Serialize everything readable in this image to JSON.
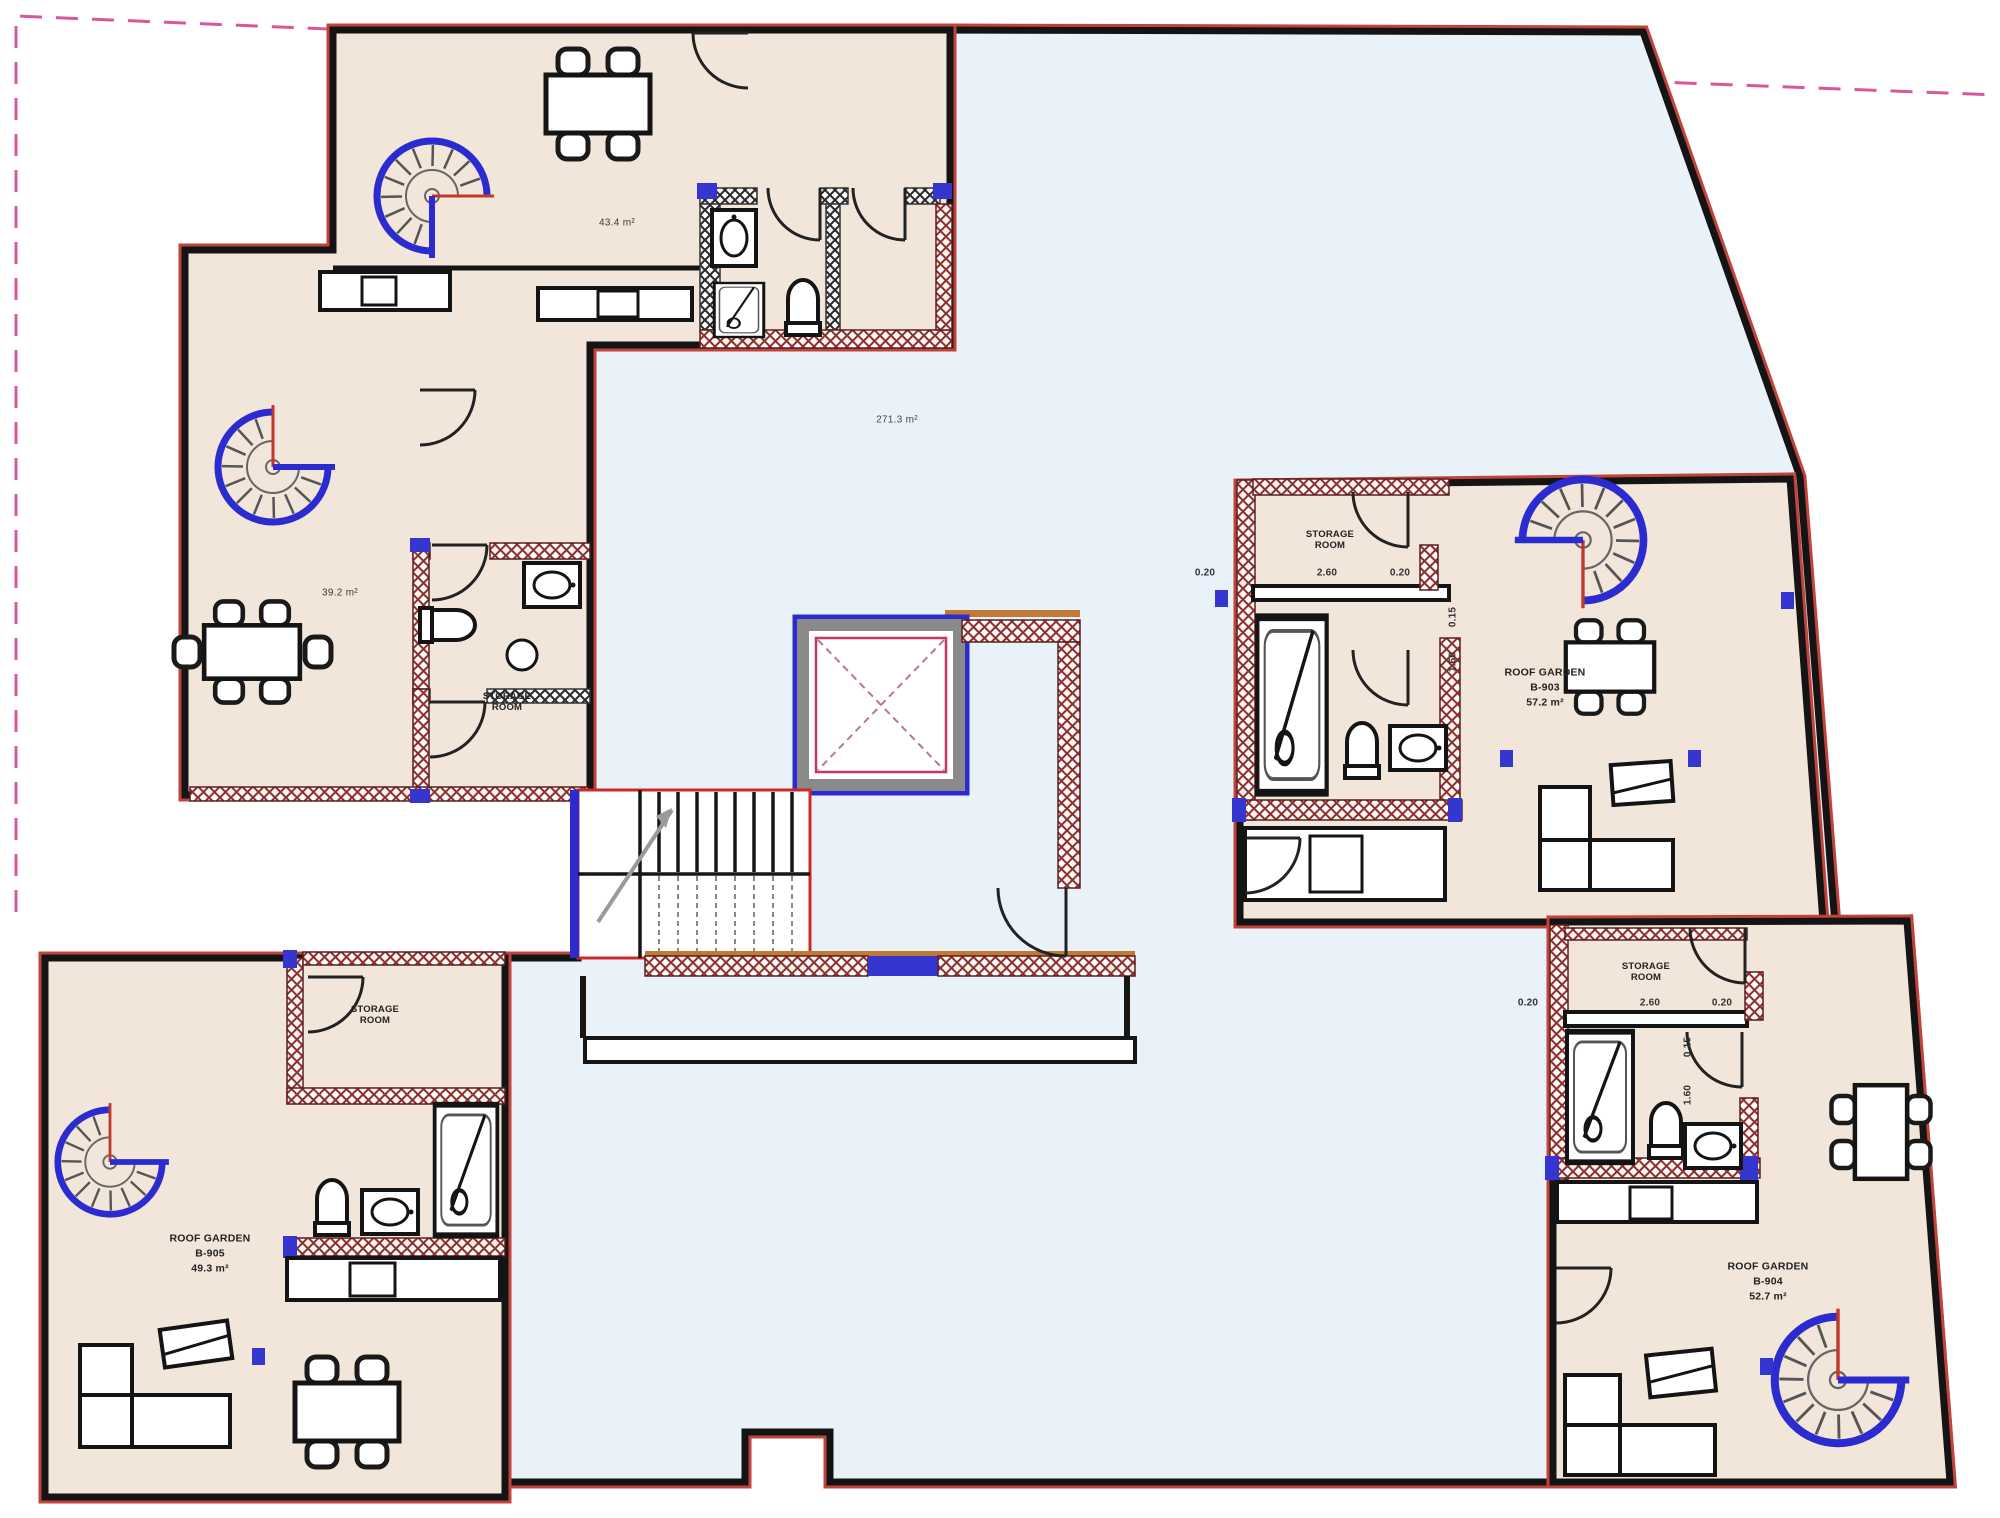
{
  "plan": {
    "areas": {
      "top_terrace": "43.4 m²",
      "courtyard": "271.3 m²",
      "left_terrace": "39.2 m²"
    },
    "storage_room_label": "STORAGE ROOM",
    "units": {
      "b903": {
        "name": "ROOF GARDEN",
        "code": "B-903",
        "area": "57.2 m²"
      },
      "b904": {
        "name": "ROOF GARDEN",
        "code": "B-904",
        "area": "52.7 m²"
      },
      "b905": {
        "name": "ROOF GARDEN",
        "code": "B-905",
        "area": "49.3 m²"
      }
    },
    "dimensions": {
      "wall_offset": "0.20",
      "storage_width": "2.60",
      "door_offset": "0.15",
      "door_width": "1.60"
    },
    "colors": {
      "terrace_fill": "#f2e5d9",
      "open_roof_fill": "#e9f2f8",
      "wall": "#141414",
      "outline_red": "#c0443c",
      "accent_blue": "#2b2bd0",
      "hatch_red": "#8c2f2f",
      "boundary_dashed_pink": "#d8569d",
      "stair_red": "#cc2a2a"
    }
  }
}
